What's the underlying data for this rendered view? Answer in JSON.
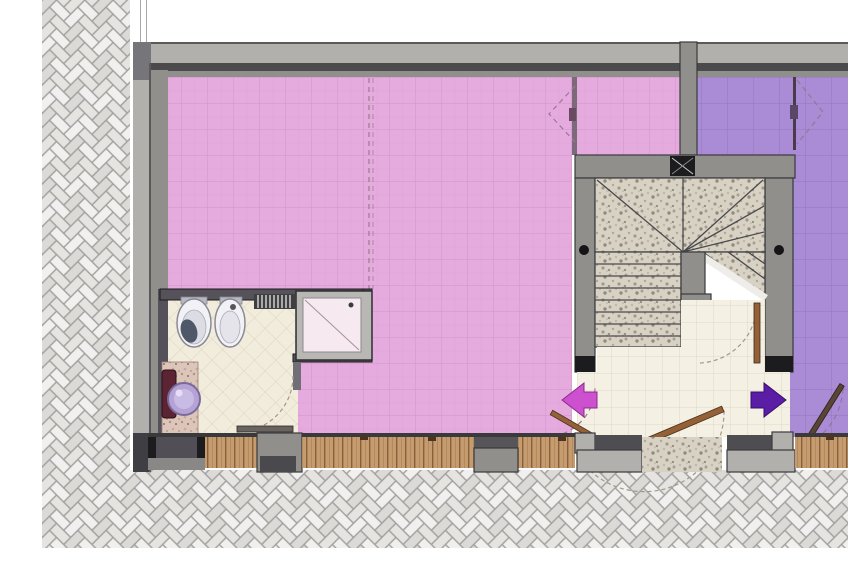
{
  "plan": {
    "kind": "architectural-floor-plan",
    "rooms": [
      {
        "id": "room-pink-large",
        "finish": "pink-tile"
      },
      {
        "id": "room-pink-upper",
        "finish": "pink-tile"
      },
      {
        "id": "room-purple",
        "finish": "purple-tile"
      },
      {
        "id": "bathroom",
        "finish": "cream-diagonal-tile"
      },
      {
        "id": "entrance-hall",
        "finish": "cream-tile"
      },
      {
        "id": "stairwell",
        "finish": "granite"
      }
    ],
    "bathroom_fixtures": [
      "toilet",
      "bidet",
      "towel-radiator",
      "shower-tray",
      "washbasin",
      "vanity-cabinet"
    ],
    "stairs": {
      "lower_flight_treads": 8,
      "winder_landing": true,
      "upper_flight": true,
      "handrail_posts": 2,
      "column_marker": true
    },
    "entrance_arrows": [
      {
        "id": "arrow-left",
        "direction": "left",
        "color": "#cd50cf"
      },
      {
        "id": "arrow-right",
        "direction": "right",
        "color": "#5a1da6"
      }
    ],
    "doors": {
      "single_swing_doors": 5,
      "double_swing_dashed_symbols": 2,
      "dashed_partition_lines": 1
    },
    "exterior": {
      "paving": "herringbone-brick",
      "sills": "wood-plank",
      "entrance_threshold": "granite"
    }
  },
  "colors": {
    "c_pink": "#e5abdf",
    "c_pink_grid": "#cf93c7",
    "c_purple": "#aa8bd5",
    "c_purple_grid": "#9277bb",
    "c_bath": "#f1ecdc",
    "c_bath_grid": "#dcd5bd",
    "c_hall": "#f4f0e4",
    "c_hall_grid": "#ded8c2",
    "c_granite": "#d8d2c5",
    "c_wood": "#c59c70",
    "c_wood_line": "#8a5f3a",
    "c_joint": "#a09f9d",
    "c_brick": "#f1f0ee",
    "c_brick2": "#e5e4e1",
    "c_wall_light": "#b2b0ad",
    "c_wall_mid": "#918f8c",
    "c_wall_dark": "#4b4b4d",
    "c_arrow_left": "#cd50cf",
    "c_arrow_right": "#5a1da6",
    "c_leaf_wood": "#936038"
  }
}
